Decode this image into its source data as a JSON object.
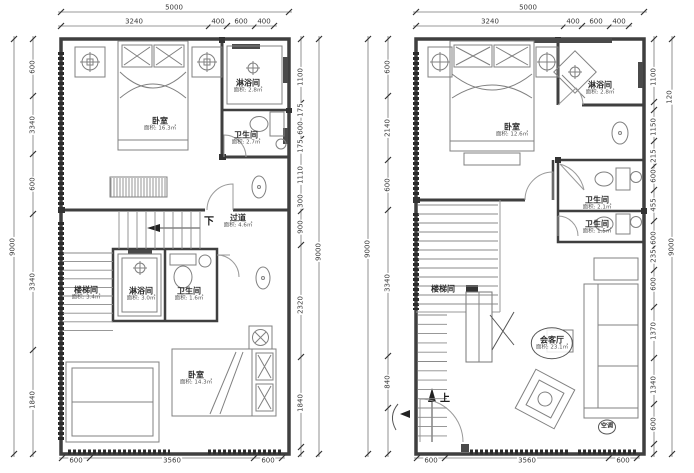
{
  "drawing": {
    "type": "architectural floor plan, two storeys side by side",
    "units": "mm",
    "colors": {
      "wall": "#3f3f3f",
      "line": "#808080",
      "dim": "#3a3a3a",
      "background": "#ffffff"
    },
    "plans": [
      {
        "id": "left-plan",
        "overall_width": "5000",
        "overall_height": "9000",
        "dims": [
          {
            "t": "5000",
            "x": 174,
            "y": 8
          },
          {
            "t": "3240",
            "x": 134,
            "y": 22
          },
          {
            "t": "400",
            "x": 218,
            "y": 22
          },
          {
            "t": "600",
            "x": 241,
            "y": 22
          },
          {
            "t": "400",
            "x": 264,
            "y": 22
          },
          {
            "t": "600",
            "x": 76,
            "y": 461
          },
          {
            "t": "3560",
            "x": 172,
            "y": 461
          },
          {
            "t": "600",
            "x": 268,
            "y": 461
          },
          {
            "t": "9000",
            "x": 13,
            "y": 247,
            "r": 1
          },
          {
            "t": "600",
            "x": 33,
            "y": 67,
            "r": 1
          },
          {
            "t": "3340",
            "x": 33,
            "y": 125,
            "r": 1
          },
          {
            "t": "600",
            "x": 33,
            "y": 184,
            "r": 1
          },
          {
            "t": "3340",
            "x": 33,
            "y": 282,
            "r": 1
          },
          {
            "t": "1840",
            "x": 33,
            "y": 400,
            "r": 1
          },
          {
            "t": "1100",
            "x": 301,
            "y": 77,
            "r": 1
          },
          {
            "t": "175",
            "x": 301,
            "y": 110,
            "r": 1
          },
          {
            "t": "600",
            "x": 301,
            "y": 128,
            "r": 1
          },
          {
            "t": "175",
            "x": 301,
            "y": 146,
            "r": 1
          },
          {
            "t": "1110",
            "x": 301,
            "y": 175,
            "r": 1
          },
          {
            "t": "300",
            "x": 301,
            "y": 201,
            "r": 1
          },
          {
            "t": "900",
            "x": 301,
            "y": 227,
            "r": 1
          },
          {
            "t": "2320",
            "x": 301,
            "y": 305,
            "r": 1
          },
          {
            "t": "1840",
            "x": 301,
            "y": 403,
            "r": 1
          },
          {
            "t": "9000",
            "x": 319,
            "y": 252,
            "r": 1
          }
        ],
        "rooms": [
          {
            "t": "卧室",
            "sub": "面积: 16.3㎡",
            "x": 160,
            "y": 124
          },
          {
            "t": "淋浴间",
            "sub": "面积: 2.8㎡",
            "x": 248,
            "y": 86
          },
          {
            "t": "卫生间",
            "sub": "面积: 2.7㎡",
            "x": 246,
            "y": 138
          },
          {
            "t": "过道",
            "sub": "面积: 4.6㎡",
            "x": 238,
            "y": 221
          },
          {
            "t": "楼梯间",
            "sub": "面积: 3.4㎡",
            "x": 86,
            "y": 293
          },
          {
            "t": "淋浴间",
            "sub": "面积: 3.0㎡",
            "x": 141,
            "y": 294
          },
          {
            "t": "卫生间",
            "sub": "面积: 1.6㎡",
            "x": 189,
            "y": 294
          },
          {
            "t": "卧室",
            "sub": "面积: 14.3㎡",
            "x": 196,
            "y": 378
          }
        ],
        "notes": [
          {
            "t": "下",
            "x": 209,
            "y": 220
          }
        ]
      },
      {
        "id": "right-plan",
        "overall_width": "5000",
        "overall_height": "9000",
        "dims": [
          {
            "t": "5000",
            "x": 528,
            "y": 8
          },
          {
            "t": "3240",
            "x": 490,
            "y": 22
          },
          {
            "t": "400",
            "x": 573,
            "y": 22
          },
          {
            "t": "600",
            "x": 596,
            "y": 22
          },
          {
            "t": "400",
            "x": 619,
            "y": 22
          },
          {
            "t": "600",
            "x": 431,
            "y": 461
          },
          {
            "t": "3560",
            "x": 527,
            "y": 461
          },
          {
            "t": "600",
            "x": 623,
            "y": 461
          },
          {
            "t": "9000",
            "x": 368,
            "y": 249,
            "r": 1
          },
          {
            "t": "600",
            "x": 388,
            "y": 67,
            "r": 1
          },
          {
            "t": "2140",
            "x": 388,
            "y": 128,
            "r": 1
          },
          {
            "t": "600",
            "x": 388,
            "y": 185,
            "r": 1
          },
          {
            "t": "3340",
            "x": 388,
            "y": 283,
            "r": 1
          },
          {
            "t": "840",
            "x": 388,
            "y": 382,
            "r": 1
          },
          {
            "t": "1100",
            "x": 654,
            "y": 77,
            "r": 1
          },
          {
            "t": "120",
            "x": 670,
            "y": 97,
            "r": 1
          },
          {
            "t": "1150",
            "x": 654,
            "y": 127,
            "r": 1
          },
          {
            "t": "215",
            "x": 654,
            "y": 156,
            "r": 1
          },
          {
            "t": "600",
            "x": 654,
            "y": 176,
            "r": 1
          },
          {
            "t": "455",
            "x": 654,
            "y": 205,
            "r": 1
          },
          {
            "t": "600",
            "x": 654,
            "y": 238,
            "r": 1
          },
          {
            "t": "235",
            "x": 654,
            "y": 256,
            "r": 1
          },
          {
            "t": "600",
            "x": 654,
            "y": 284,
            "r": 1
          },
          {
            "t": "1370",
            "x": 654,
            "y": 331,
            "r": 1
          },
          {
            "t": "1340",
            "x": 654,
            "y": 385,
            "r": 1
          },
          {
            "t": "600",
            "x": 654,
            "y": 424,
            "r": 1
          },
          {
            "t": "9000",
            "x": 672,
            "y": 247,
            "r": 1
          }
        ],
        "rooms": [
          {
            "t": "卧室",
            "sub": "面积: 12.6㎡",
            "x": 512,
            "y": 130
          },
          {
            "t": "淋浴间",
            "sub": "面积: 2.8㎡",
            "x": 600,
            "y": 88
          },
          {
            "t": "卫生间",
            "sub": "面积: 2.1㎡",
            "x": 597,
            "y": 203
          },
          {
            "t": "卫生间",
            "sub": "面积: 1.5㎡",
            "x": 597,
            "y": 227
          },
          {
            "t": "楼梯间",
            "sub": "",
            "x": 443,
            "y": 289
          },
          {
            "t": "会客厅",
            "sub": "面积: 23.1㎡",
            "x": 552,
            "y": 343,
            "circled": true
          },
          {
            "t": "空调",
            "sub": "",
            "x": 607,
            "y": 427,
            "circled": true,
            "small": true
          }
        ],
        "notes": [
          {
            "t": "上",
            "x": 445,
            "y": 397
          }
        ]
      }
    ]
  }
}
